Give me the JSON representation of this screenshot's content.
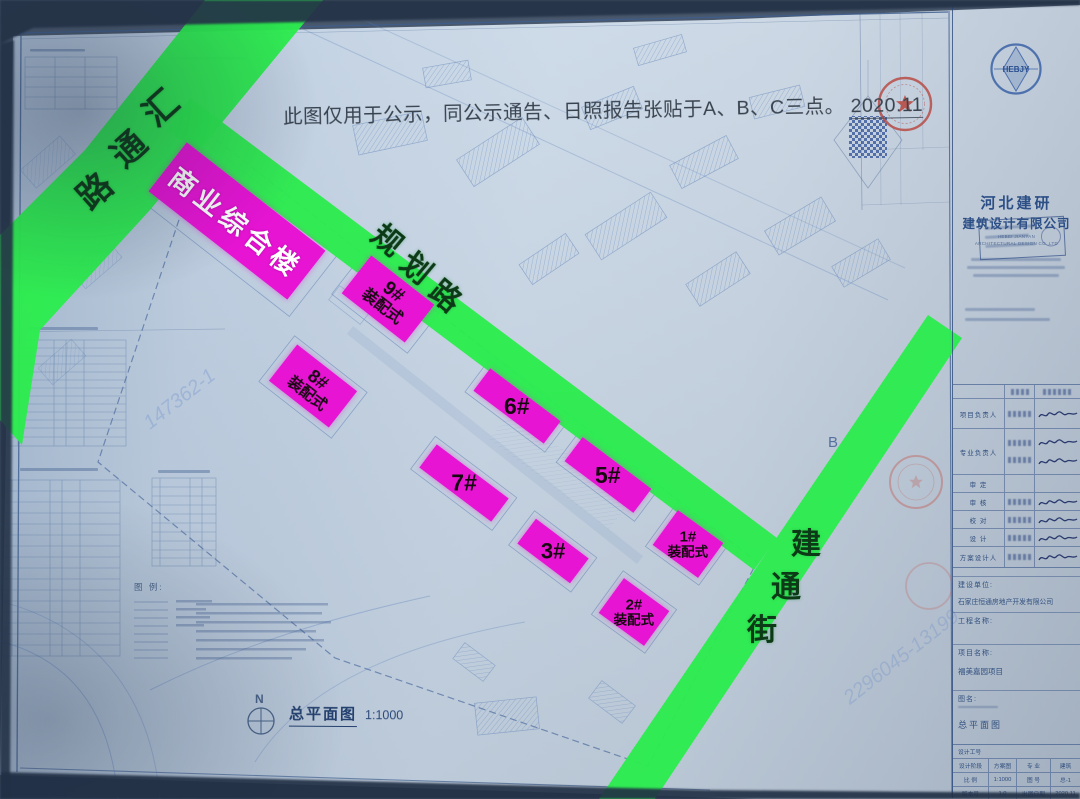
{
  "notice": {
    "text": "此图仅用于公示，同公示通告、日照报告张贴于A、B、C三点。",
    "date": "2020.11"
  },
  "roads": [
    {
      "name": "汇通路",
      "chars": [
        "汇",
        "通",
        "路"
      ]
    },
    {
      "name": "规划路",
      "chars": [
        "规",
        "划",
        "路"
      ]
    },
    {
      "name": "建通街",
      "chars": [
        "建",
        "通",
        "街"
      ]
    }
  ],
  "buildings": [
    {
      "label": "商业综合楼"
    },
    {
      "num": "9#",
      "sub": "装配式"
    },
    {
      "num": "8#",
      "sub": "装配式"
    },
    {
      "num": "6#"
    },
    {
      "num": "5#"
    },
    {
      "num": "7#"
    },
    {
      "num": "3#"
    },
    {
      "num": "1#",
      "sub": "装配式"
    },
    {
      "num": "2#",
      "sub": "装配式"
    }
  ],
  "plan_label": {
    "north": "N",
    "title": "总平面图",
    "scale": "1:1000",
    "marker_b": "B"
  },
  "legend": {
    "title": "图 例:"
  },
  "watermarks": [
    "147362-1",
    "2296045-13199"
  ],
  "colors": {
    "road_green": "#2cec4e",
    "building_magenta": "#e714d4",
    "stamp_red": "#b8443c"
  },
  "title_block": {
    "logo_text": "HEBJY",
    "company_cn_1": "河北建研",
    "company_cn_2": "建筑设计有限公司",
    "company_en_1": "HEBEI JIANYAN",
    "company_en_2": "ARCHITECTURAL DESIGN CO.,LTD",
    "sig_rows": [
      "项目负责人",
      "专业负责人",
      "审 定",
      "审 核",
      "校 对",
      "设 计",
      "方案设计人"
    ],
    "client_label": "建设单位:",
    "client_name": "石家庄恒通房地产开发有限公司",
    "project_label": "工程名称:",
    "name_label": "项目名称:",
    "project_name": "福美嘉园项目",
    "drawing_label": "图名:",
    "drawing_name": "总平面图",
    "job_label": "设计工号",
    "grid_rows": [
      [
        "设计阶段",
        "方案图",
        "专 业",
        "建筑"
      ],
      [
        "比 例",
        "1:1000",
        "图 号",
        "总-1"
      ],
      [
        "版本号",
        "1.0",
        "出图日期",
        "2020.11"
      ]
    ]
  }
}
